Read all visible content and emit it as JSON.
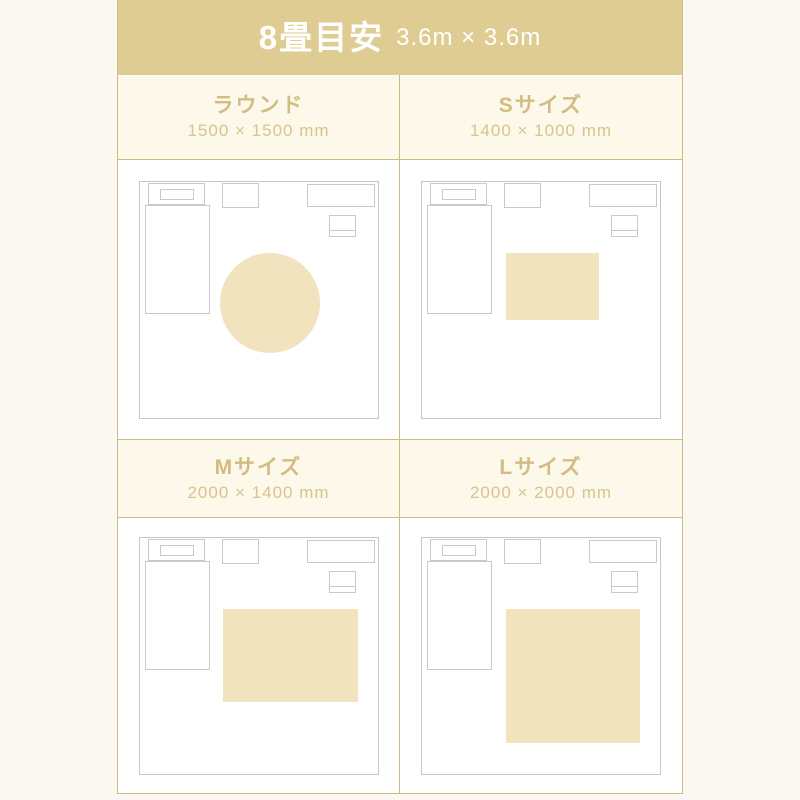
{
  "title": {
    "main": "8畳目安",
    "sub": "3.6m × 3.6m"
  },
  "colors": {
    "title_band_bg": "#dfcc92",
    "title_text": "#ffffff",
    "page_bg": "#faf8f0",
    "quadrant_header_bg": "#fcf8ea",
    "quadrant_header_text": "#d2bc82",
    "grid_border": "#ccbb83",
    "room_outline": "#c6c6ca",
    "rug_fill": "#f0e3bd"
  },
  "room_legend": {
    "scale": "room square represents 3.6m × 3.6m",
    "furniture": [
      "bed",
      "pillow",
      "desk",
      "dresser",
      "nightstand"
    ]
  },
  "quadrants": [
    {
      "label": "ラウンド",
      "size": "1500 × 1500 mm",
      "rug": {
        "shape": "circle",
        "left": 80,
        "top": 71,
        "width": 100,
        "height": 100
      }
    },
    {
      "label": "Sサイズ",
      "size": "1400 × 1000 mm",
      "rug": {
        "shape": "rect",
        "left": 84,
        "top": 71,
        "width": 93,
        "height": 67
      }
    },
    {
      "label": "Mサイズ",
      "size": "2000 × 1400 mm",
      "rug": {
        "shape": "rect",
        "left": 83,
        "top": 71,
        "width": 135,
        "height": 93
      }
    },
    {
      "label": "Lサイズ",
      "size": "2000 × 2000 mm",
      "rug": {
        "shape": "rect",
        "left": 84,
        "top": 71,
        "width": 134,
        "height": 134
      }
    }
  ]
}
